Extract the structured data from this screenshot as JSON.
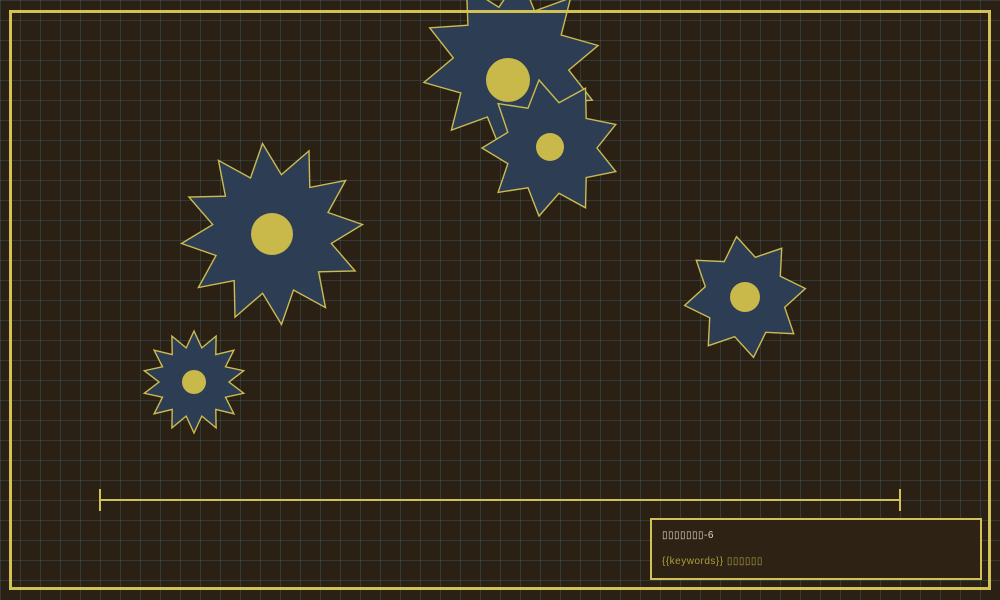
{
  "scene": {
    "background_color": "#2b2014",
    "grid_color": "rgba(74,116,146,0.30)",
    "grid_size": 20,
    "frame_color": "#d2c155"
  },
  "gear_style": {
    "fill": "#2d3e54",
    "stroke": "#cbbb50",
    "stroke_width": 1.4,
    "hub_fill": "#c9b84a"
  },
  "gears": [
    {
      "name": "gear-top-large",
      "cx": 511,
      "cy": 64,
      "outer_radius": 89,
      "inner_radius": 58,
      "teeth": 10,
      "rotation_deg": 6,
      "hub_cx": 508,
      "hub_cy": 80,
      "hub_radius": 22
    },
    {
      "name": "gear-top-small",
      "cx": 551,
      "cy": 148,
      "outer_radius": 69,
      "inner_radius": 46,
      "teeth": 9,
      "rotation_deg": -10,
      "hub_cx": 550,
      "hub_cy": 147,
      "hub_radius": 14
    },
    {
      "name": "gear-left-large",
      "cx": 272,
      "cy": 234,
      "outer_radius": 91,
      "inner_radius": 60,
      "teeth": 12,
      "rotation_deg": -6,
      "hub_cx": 272,
      "hub_cy": 234,
      "hub_radius": 21
    },
    {
      "name": "gear-left-small",
      "cx": 194,
      "cy": 382,
      "outer_radius": 51,
      "inner_radius": 35,
      "teeth": 14,
      "rotation_deg": 0,
      "hub_cx": 194,
      "hub_cy": 382,
      "hub_radius": 12
    },
    {
      "name": "gear-right",
      "cx": 745,
      "cy": 297,
      "outer_radius": 61,
      "inner_radius": 41,
      "teeth": 8,
      "rotation_deg": -8,
      "hub_cx": 745,
      "hub_cy": 297,
      "hub_radius": 15
    }
  ],
  "timeline": {
    "x_start": 100,
    "x_end": 900,
    "y": 500,
    "cap_height": 22,
    "thickness": 2,
    "color": "#d2c155"
  },
  "info_box": {
    "line1": "▯▯▯▯▯▯▯-6",
    "line2": "{{keywords}} ▯▯▯▯▯▯",
    "line1_color": "#ddd8ca",
    "line2_color": "#ab9f3d",
    "border_color": "#d2c155",
    "background_color": "#2e2215"
  }
}
